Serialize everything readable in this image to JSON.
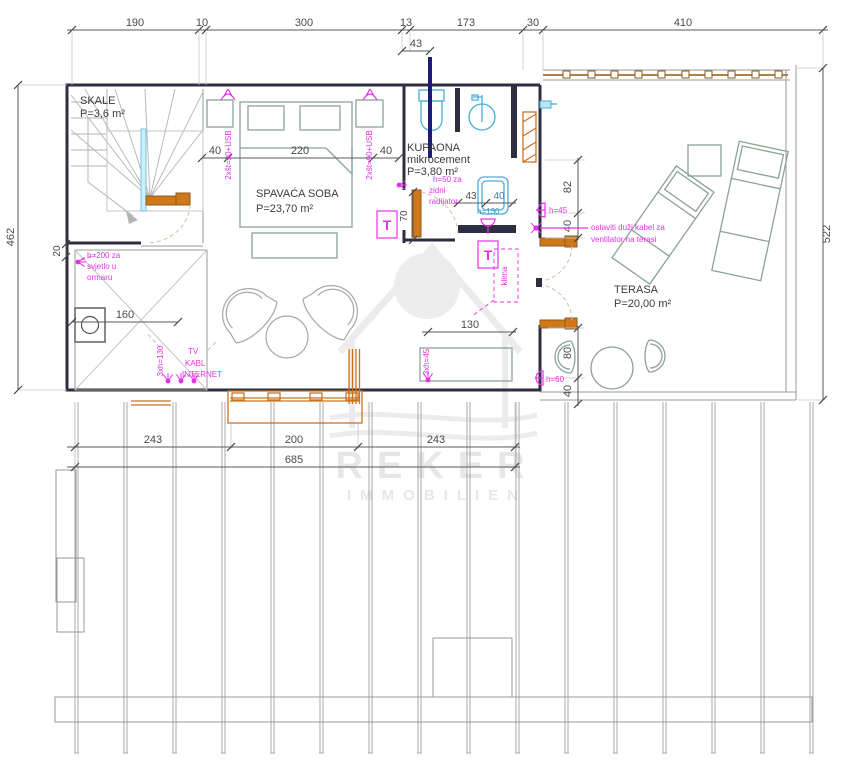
{
  "watermark": {
    "name": "REKER",
    "sub": "IMMOBILIEN"
  },
  "rooms": {
    "skale": {
      "name": "SKALE",
      "area": "P=3,6 m²"
    },
    "bedroom": {
      "name": "SPAVAĆA SOBA",
      "area": "P=23,70 m²"
    },
    "bathroom": {
      "name": "KUPAONA",
      "material": "mikrocement",
      "area": "P=3,80 m²"
    },
    "terrace": {
      "name": "TERASA",
      "area": "P=20,00 m²"
    }
  },
  "dims": {
    "top": [
      "190",
      "10",
      "300",
      "13",
      "173",
      "30",
      "410"
    ],
    "top_sub": "43",
    "left": "462",
    "left_small": "20",
    "right": "522",
    "bottom": [
      "243",
      "200",
      "243"
    ],
    "bottom_total": "685",
    "bed": [
      "40",
      "220",
      "40"
    ],
    "wardrobe": "160",
    "living": "130",
    "bath_w": "43",
    "bath_w2": "40",
    "bath_h": "70",
    "terrace_left": [
      "82",
      "40"
    ],
    "terrace_bottom": [
      "80",
      "40"
    ]
  },
  "ann": {
    "socket_left": "2xšt=90+USB",
    "socket_right": "2xšt=90+USB",
    "wardrobe_light": [
      "h=200 za",
      "svjetlo u",
      "ormaru"
    ],
    "tv": [
      "TV",
      "KABL",
      "INTERNET"
    ],
    "tv_sockets": "3xh=130",
    "bench_sockets": "3xh=45",
    "radiator": [
      "h=50 za",
      "zidni",
      "radijator"
    ],
    "shower": "h=130",
    "light_upper": "h=45",
    "light_lower": "h=60",
    "fan": [
      "ostaviti duži kabel za",
      "ventilator na terasi"
    ],
    "t_mark": "T",
    "klima": "klima"
  },
  "colors": {
    "magenta": "#e632e6",
    "cyan": "#49aed6",
    "orange": "#c9731f",
    "navy": "#1c1c78",
    "wall": "#2e2e40"
  }
}
